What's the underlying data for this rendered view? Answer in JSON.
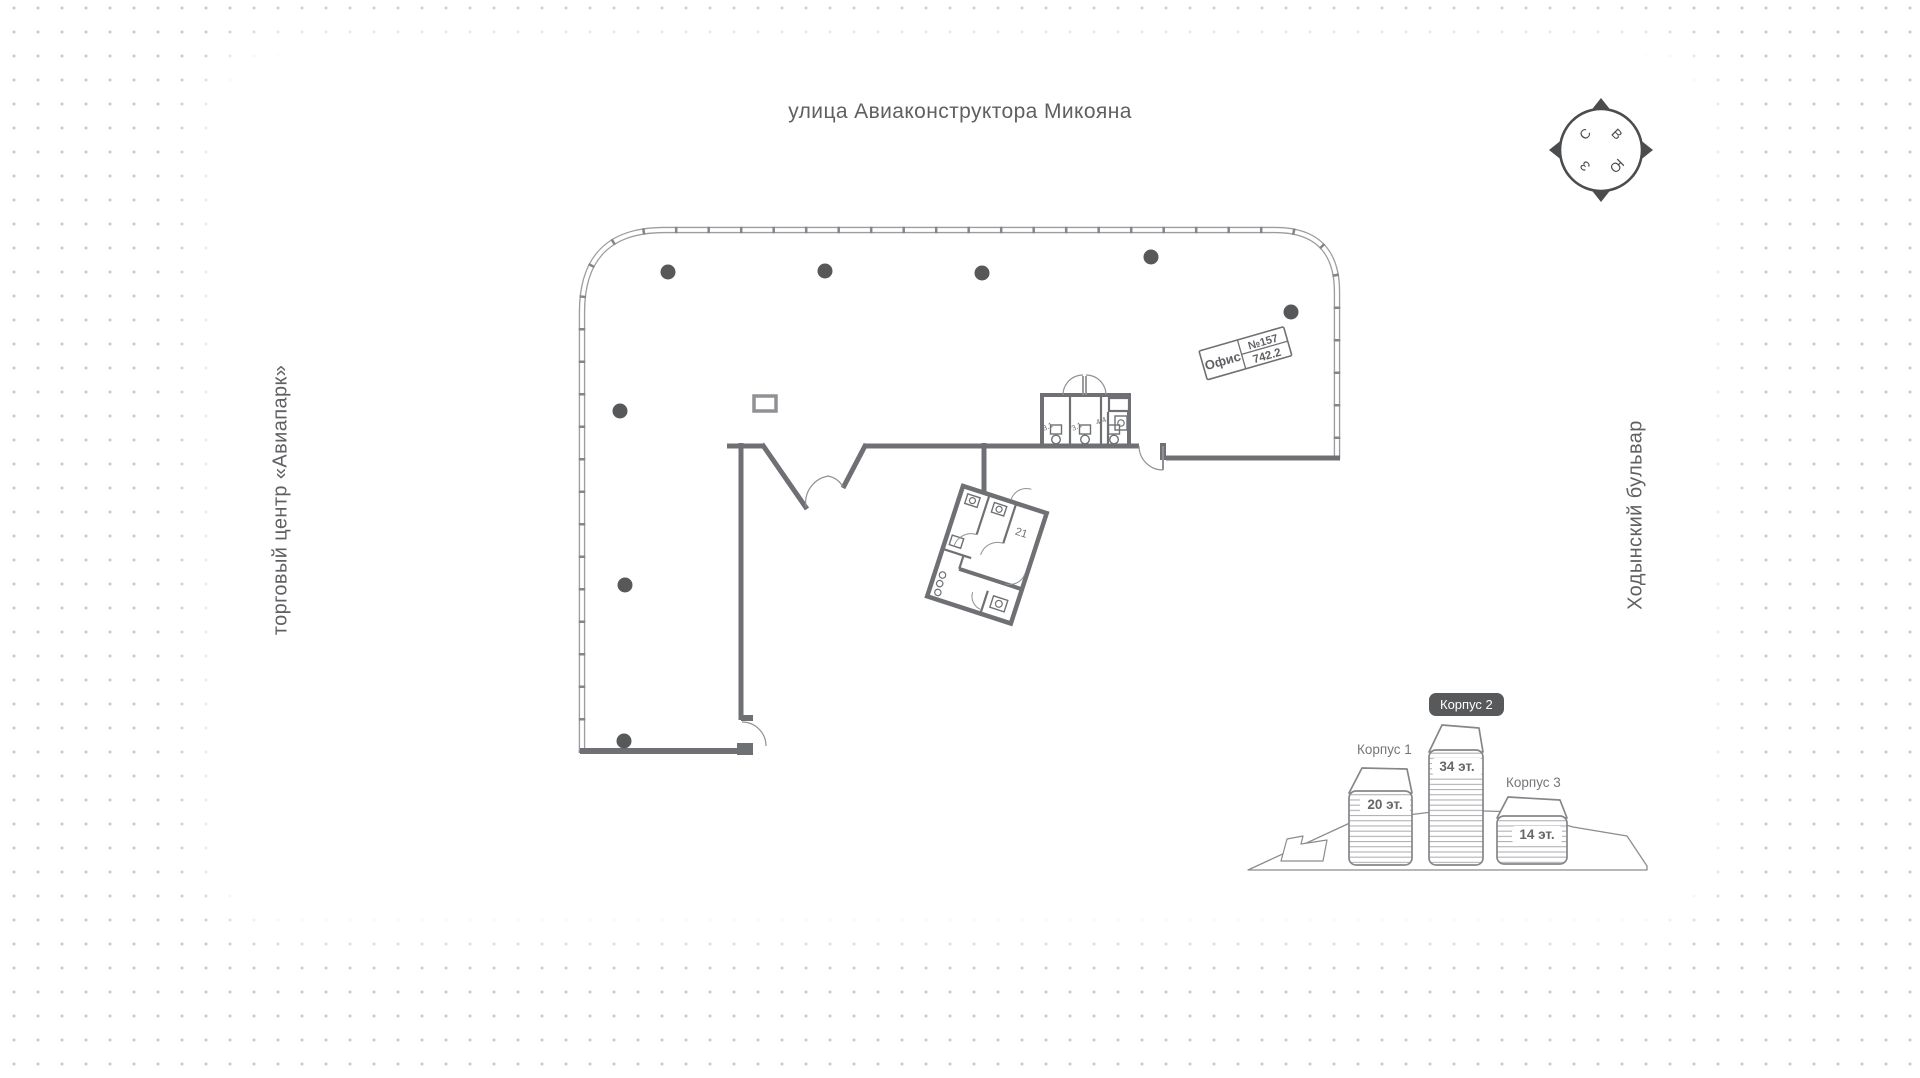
{
  "labels": {
    "street_top": "улица Авиаконструктора Микояна",
    "left_side": "торговый центр «Авиапарк»",
    "right_side": "Ходынский бульвар"
  },
  "compass": {
    "north": "С",
    "east": "В",
    "south": "Ю",
    "west": "З"
  },
  "office_tag": {
    "name": "Офис",
    "number": "№157",
    "area": "742.2"
  },
  "plan": {
    "room_label": "21",
    "wc_labels": [
      "3.1",
      "3.1",
      "4.4"
    ]
  },
  "buildings_diagram": {
    "buildings": [
      {
        "name": "Корпус 1",
        "floors": "20 эт.",
        "highlighted": false
      },
      {
        "name": "Корпус 2",
        "floors": "34 эт.",
        "highlighted": true
      },
      {
        "name": "Корпус 3",
        "floors": "14 эт.",
        "highlighted": false
      }
    ]
  },
  "colors": {
    "dot_grid": "#c8cacc",
    "facade": "#9b9da0",
    "wall": "#6e7073",
    "column": "#57585a",
    "badge_bg": "#58595b",
    "text_gray": "#5f6063"
  }
}
